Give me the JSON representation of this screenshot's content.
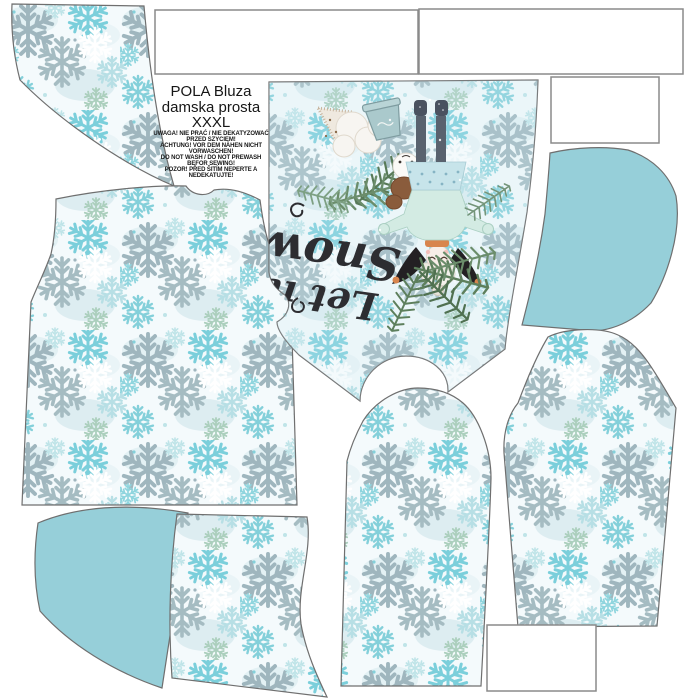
{
  "sheet": {
    "label": {
      "title_lines": [
        "POLA Bluza",
        "damska prosta",
        "XXXL"
      ],
      "warning_lines": [
        "UWAGA! NIE PRAĆ / NIE DEKATYZOWAĆ",
        "PRZED SZYCIEM!",
        "ACHTUNG! VOR DEM NÄHEN NICHT",
        "VORWASCHEN!",
        "DO NOT WASH / DO NOT PREWASH",
        "BEFOR SEWING!",
        "POZOR! PŘED ŠITÍM NEPERTE A",
        "NEDEKATUJTE!"
      ]
    },
    "panel_script": {
      "line1": "Let it",
      "line2": "Snow"
    },
    "colors": {
      "teal_solid": "#96cfd9",
      "fabric_background": "#f4fafc",
      "flake_turquoise": "#7bcfdb",
      "flake_gray": "#9fb6be",
      "flake_pale": "#b7dfe5",
      "piece_outline": "#6f6f6f",
      "box_border": "#8a8a8a",
      "script_ink": "#2d2d31"
    }
  }
}
